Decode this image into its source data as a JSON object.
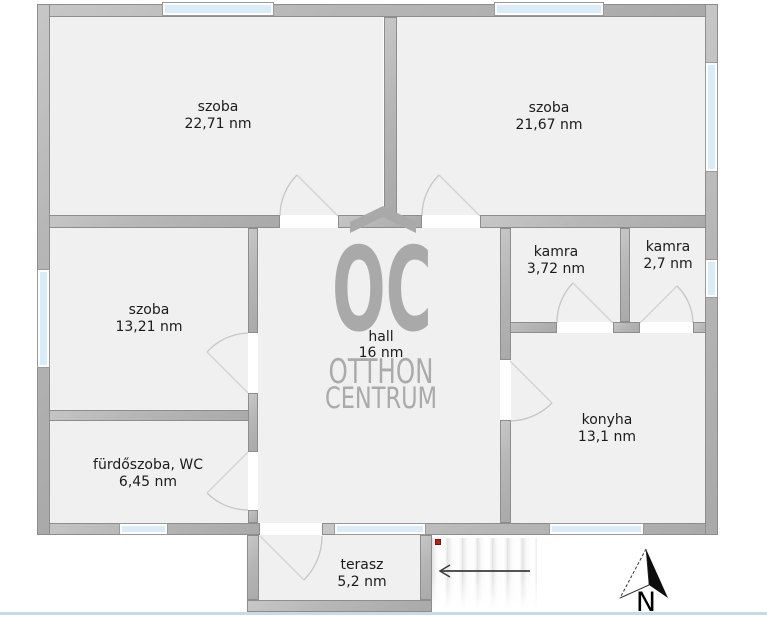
{
  "rooms": [
    {
      "label": "szoba",
      "area": "22,71 nm"
    },
    {
      "label": "szoba",
      "area": "21,67 nm"
    },
    {
      "label": "szoba",
      "area": "13,21 nm"
    },
    {
      "label": "hall",
      "area": "16 nm"
    },
    {
      "label": "kamra",
      "area": "3,72 nm"
    },
    {
      "label": "kamra",
      "area": "2,7 nm"
    },
    {
      "label": "konyha",
      "area": "13,1 nm"
    },
    {
      "label": "fürdőszoba, WC",
      "area": "6,45 nm"
    },
    {
      "label": "terasz",
      "area": "5,2 nm"
    }
  ],
  "watermark": {
    "monogram": "OC",
    "line1": "OTTHON",
    "line2": "CENTRUM"
  },
  "compass": {
    "north_label": "N"
  },
  "colors": {
    "wall": "#b6b6b6",
    "room_fill": "#f0f0f1",
    "window_glass": "#d9ecf7",
    "watermark_gray": "#a9a9a9",
    "marker_red": "#b3241c",
    "bottom_border": "#ccd9e3"
  }
}
